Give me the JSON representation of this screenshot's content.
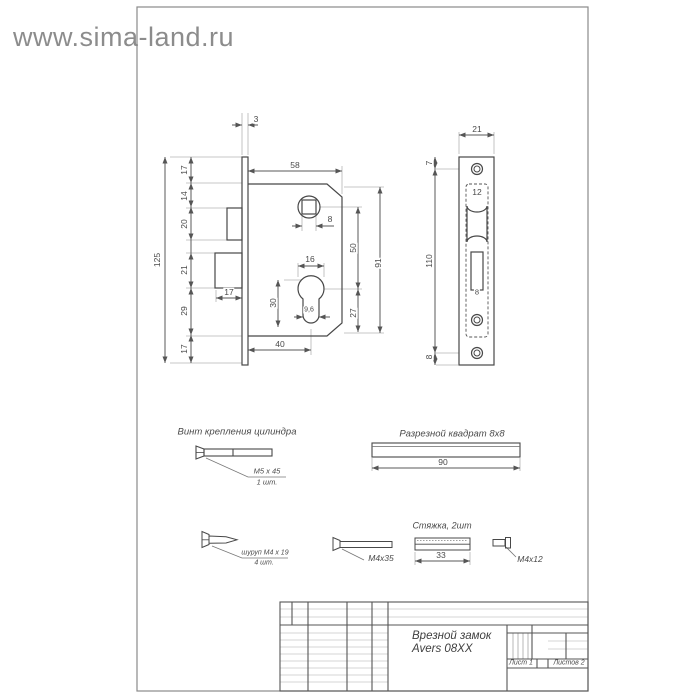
{
  "watermark": {
    "text": "www.sima-land.ru"
  },
  "main_view": {
    "dim_3": "3",
    "dim_58": "58",
    "dim_17_top": "17",
    "dim_14": "14",
    "dim_20": "20",
    "dim_21": "21",
    "dim_29": "29",
    "dim_17_bottom": "17",
    "dim_125": "125",
    "dim_17_bolt": "17",
    "dim_40": "40",
    "dim_8_square": "8",
    "dim_16": "16",
    "dim_30": "30",
    "dim_9_6": "9,6",
    "dim_50": "50",
    "dim_27": "27",
    "dim_91": "91"
  },
  "faceplate_view": {
    "dim_21": "21",
    "dim_7": "7",
    "dim_110": "110",
    "dim_8_bottom": "8",
    "dim_12": "12",
    "dim_8_bolt": "8"
  },
  "parts": {
    "cylinder_screw_title": "Винт крепления цилиндра",
    "cylinder_screw_size": "М5 х 45",
    "cylinder_screw_qty": "1 шт.",
    "square_bar_title": "Разрезной квадрат 8х8",
    "square_bar_length": "90",
    "wood_screw_size": "шуруп М4 х 19",
    "wood_screw_qty": "4 шт.",
    "machine_screw_label": "М4х35",
    "tie_title": "Стяжка, 2шт",
    "tie_length": "33",
    "sleeve_label": "М4х12"
  },
  "title_block": {
    "product_line1": "Врезной замок",
    "product_line2": "Avers 08XX",
    "sheet": "Лист 1",
    "sheets": "Листов 2"
  }
}
